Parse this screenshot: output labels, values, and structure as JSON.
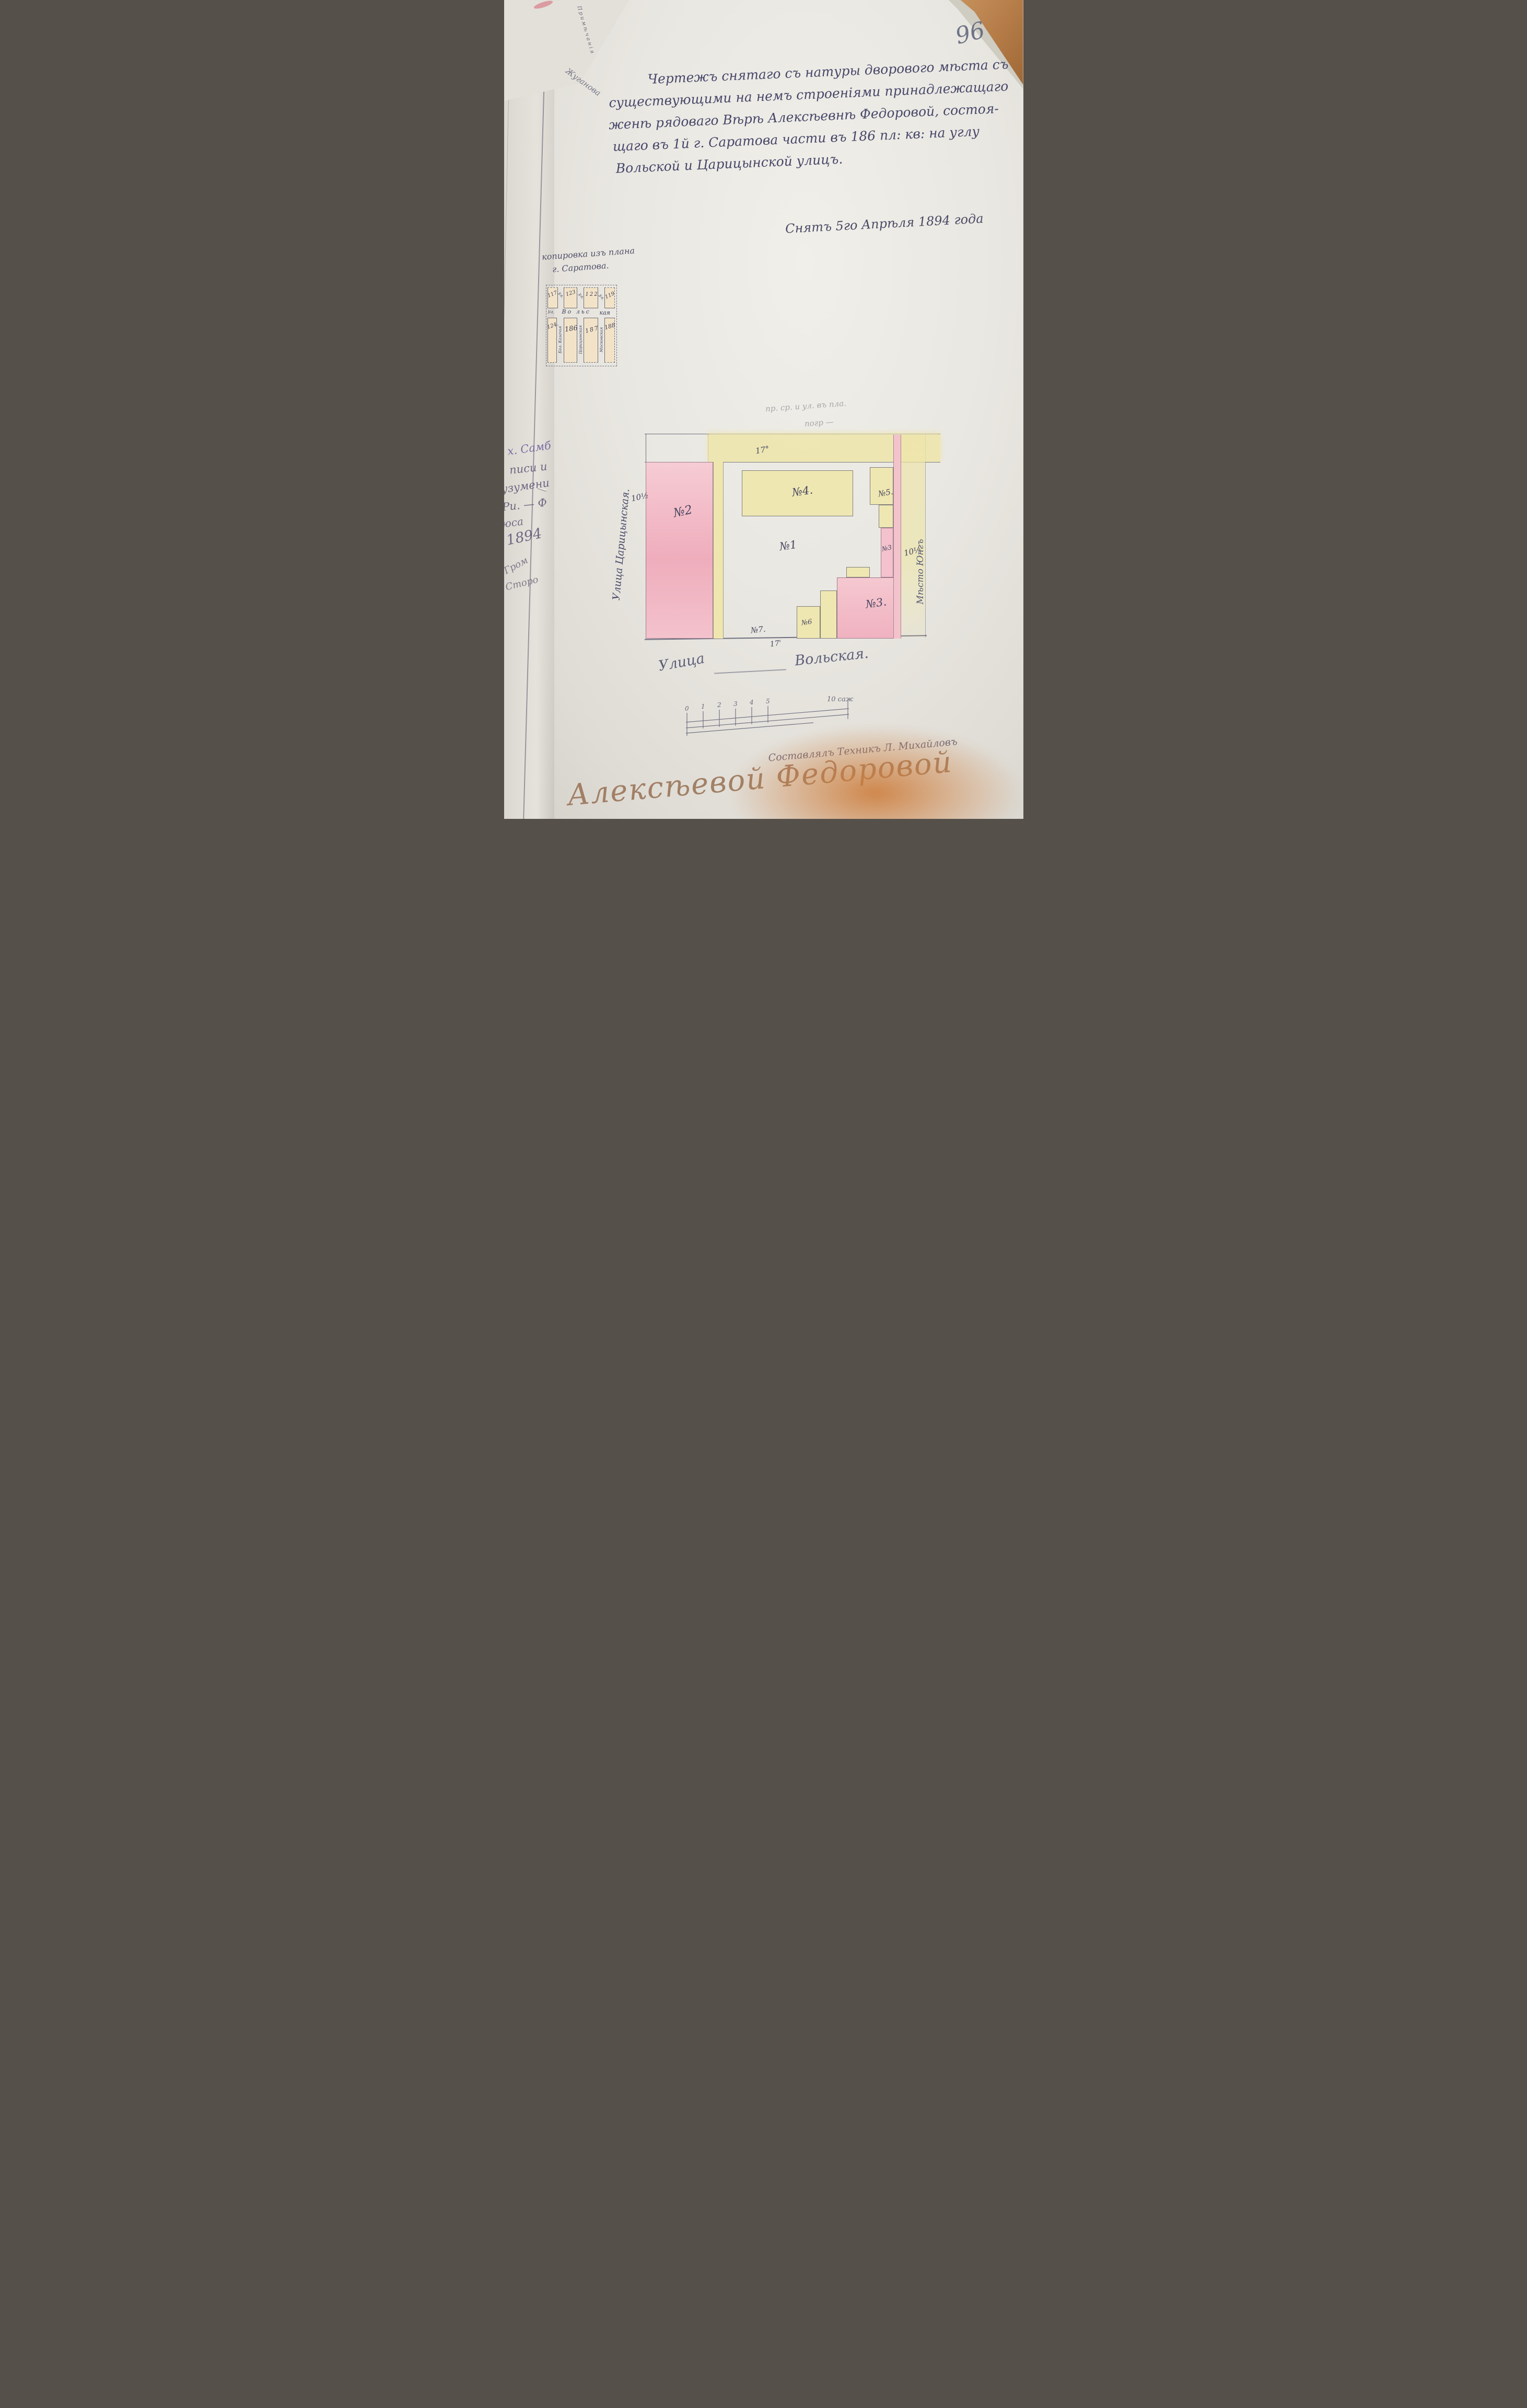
{
  "page": {
    "number": "96"
  },
  "heading": {
    "lines": [
      "Чертежъ снятаго съ натуры дворового мѣста съ",
      "существующими на немъ строеніями принадлежащаго",
      "женѣ рядоваго Вѣрѣ Алексѣевнѣ Федоровой, состоя-",
      "щаго въ 1й г. Саратова части въ 186 пл: кв: на углу",
      "Вольской и Царицынской улицъ."
    ],
    "date": "Снятъ 5го Апрѣля 1894 года"
  },
  "inset": {
    "caption1": "копировка изъ плана",
    "caption2": "г. Саратова.",
    "ul": "ул.",
    "street_h1": "Во льс",
    "street_h2": "кая",
    "top_blocks": [
      "117",
      "123",
      "122",
      "119"
    ],
    "bottom_blocks": [
      "124.",
      "186",
      "187",
      "188"
    ],
    "vstreets": [
      "Бол. Казачья",
      "Царицынская",
      "Московская"
    ]
  },
  "plan": {
    "labels": {
      "n1": "№1",
      "n2": "№2",
      "n3": "№3.",
      "n3s": "№3",
      "n4": "№4.",
      "n5": "№5.",
      "n6": "№6",
      "n7": "№7."
    },
    "dims": {
      "top": "17°",
      "bottom": "17'",
      "left": "10½",
      "right": "10½"
    },
    "street_left": "Улица Царицынская.",
    "street_bottom1": "Улица",
    "street_bottom2": "Вольская.",
    "right_note": "Мѣсто Юнгъ",
    "pencil1": "пр. ср. и ул. въ пла.",
    "pencil2": "погр —"
  },
  "scale": {
    "ticks": [
      "0",
      "1",
      "2",
      "3",
      "4",
      "5"
    ],
    "end": "10 саж"
  },
  "sign": {
    "maker": "Составлялъ Техникъ Л. Михайловъ",
    "owner": "Алексѣевой Федоровой"
  },
  "margin": {
    "header": "Примѣчанія",
    "note": "Жуганова",
    "fragments": [
      "х. Самб",
      "писи и",
      "узумени",
      "Ри. — Ф",
      "юса",
      "1894",
      "Гром",
      "Сторо"
    ]
  }
}
